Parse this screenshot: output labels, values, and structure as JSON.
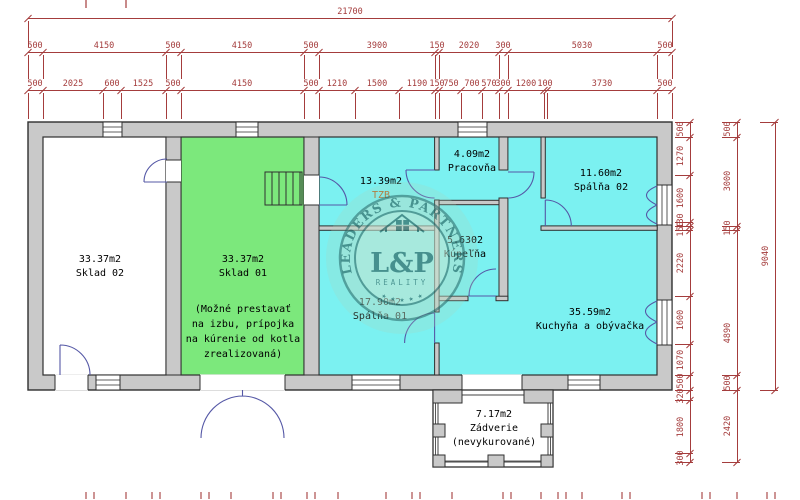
{
  "plan_title": "floor plan",
  "colors": {
    "wall_fill": "#c9c9c9",
    "outline": "#2f2f2f",
    "room_cyan": "#7bf1f1",
    "room_green": "#7ce87c",
    "dimension": "#a43c3c",
    "door_swing": "#5558a6",
    "tzb_label": "#b4641e",
    "watermark_teal": "#2e6e6c"
  },
  "rooms": {
    "sklad02": {
      "area": "33.37m2",
      "name": "Sklad 02"
    },
    "sklad01": {
      "area": "33.37m2",
      "name": "Sklad 01",
      "note_lines": [
        "(Možné prestavať",
        "na izbu, prípojka",
        "na kúrenie od kotla",
        "zrealizovaná)"
      ]
    },
    "tzb": {
      "area": "13.39m2",
      "name": "TZB"
    },
    "spalna01": {
      "area": "17.90m2",
      "name": "Spálňa 01"
    },
    "pracovna": {
      "area": "4.09m2",
      "name": "Pracovňa"
    },
    "kupelna": {
      "area": "5.6302",
      "name": "Kúpeľňa"
    },
    "spalna02": {
      "area": "11.60m2",
      "name": "Spálňa 02"
    },
    "kuchyna": {
      "area": "35.59m2",
      "name": "Kuchyňa a obývačka"
    },
    "zadverie": {
      "area": "7.17m2",
      "name": "Zádverie",
      "note": "(nevykurované)"
    }
  },
  "watermark": {
    "arc_text": "LEADERS & PARTNERS",
    "monogram": "L&P",
    "subtitle": "REALITY",
    "stars": "★ ★ ★ ★ ★"
  },
  "dims": {
    "top_rows": [
      {
        "y": 18,
        "x1": 28,
        "x2": 672,
        "ext": 26,
        "bounds": [
          28,
          672
        ],
        "labels": [
          {
            "t": "21700",
            "x": 350
          }
        ]
      },
      {
        "y": 52,
        "x1": 28,
        "x2": 672,
        "ext": 24,
        "bounds": [
          28,
          42.8,
          166,
          180.9,
          304,
          318.8,
          434.6,
          439.1,
          499,
          507.9,
          657.2,
          672
        ],
        "labels": [
          {
            "t": "500",
            "x": 35
          },
          {
            "t": "4150",
            "x": 104
          },
          {
            "t": "500",
            "x": 173
          },
          {
            "t": "4150",
            "x": 242
          },
          {
            "t": "500",
            "x": 311
          },
          {
            "t": "3900",
            "x": 377
          },
          {
            "t": "150",
            "x": 437
          },
          {
            "t": "2020",
            "x": 469
          },
          {
            "t": "300",
            "x": 503
          },
          {
            "t": "5030",
            "x": 582
          },
          {
            "t": "500",
            "x": 665
          }
        ]
      },
      {
        "y": 90,
        "x1": 28,
        "x2": 672,
        "ext": 26,
        "bounds": [
          28,
          42.8,
          103,
          120.8,
          166,
          180.9,
          304,
          318.8,
          354.7,
          399.2,
          434.6,
          439.1,
          461.3,
          482.1,
          499,
          507.9,
          543.5,
          546.5,
          657.2,
          672
        ],
        "labels": [
          {
            "t": "500",
            "x": 35
          },
          {
            "t": "2025",
            "x": 73
          },
          {
            "t": "600",
            "x": 112
          },
          {
            "t": "1525",
            "x": 143
          },
          {
            "t": "500",
            "x": 173
          },
          {
            "t": "4150",
            "x": 242
          },
          {
            "t": "500",
            "x": 311
          },
          {
            "t": "1210",
            "x": 337
          },
          {
            "t": "1500",
            "x": 377
          },
          {
            "t": "1190",
            "x": 417
          },
          {
            "t": "150",
            "x": 437
          },
          {
            "t": "750",
            "x": 451
          },
          {
            "t": "700",
            "x": 472
          },
          {
            "t": "570",
            "x": 489
          },
          {
            "t": "300",
            "x": 503
          },
          {
            "t": "1200",
            "x": 526
          },
          {
            "t": "100",
            "x": 545
          },
          {
            "t": "3730",
            "x": 602
          },
          {
            "t": "500",
            "x": 665
          }
        ]
      }
    ],
    "right_cols": [
      {
        "x": 690,
        "y1": 122,
        "y2": 462,
        "bounds": [
          122,
          136.8,
          174.5,
          222,
          225.9,
          230.3,
          296.2,
          343.7,
          375.4,
          390.3,
          399.8,
          453.2,
          462.1
        ],
        "labels": [
          {
            "t": "500",
            "y": 129
          },
          {
            "t": "1270",
            "y": 156
          },
          {
            "t": "1600",
            "y": 198
          },
          {
            "t": "130",
            "y": 221
          },
          {
            "t": "150",
            "y": 229
          },
          {
            "t": "2220",
            "y": 263
          },
          {
            "t": "1600",
            "y": 320
          },
          {
            "t": "1070",
            "y": 360
          },
          {
            "t": "500",
            "y": 381
          },
          {
            "t": "320",
            "y": 396
          },
          {
            "t": "1800",
            "y": 427
          },
          {
            "t": "300",
            "y": 458
          }
        ]
      },
      {
        "x": 737,
        "y1": 122,
        "y2": 462,
        "bounds": [
          122,
          136.8,
          225.9,
          230.3,
          375.4,
          390.3,
          462.1
        ],
        "labels": [
          {
            "t": "500",
            "y": 129
          },
          {
            "t": "3000",
            "y": 181
          },
          {
            "t": "150",
            "y": 228
          },
          {
            "t": "4890",
            "y": 333
          },
          {
            "t": "500",
            "y": 383
          },
          {
            "t": "2420",
            "y": 426
          }
        ]
      },
      {
        "x": 775,
        "y1": 122,
        "y2": 390,
        "bounds": [
          122,
          390.3
        ],
        "labels": [
          {
            "t": "9040",
            "y": 256
          }
        ]
      }
    ],
    "top_partial_ticks": [
      85,
      125
    ],
    "bottom_ticks": [
      85,
      93,
      125,
      151,
      159,
      200,
      208,
      230,
      272,
      280,
      306,
      314,
      337,
      385,
      411,
      419,
      451,
      502,
      510,
      540,
      557,
      565,
      581,
      621,
      629,
      701,
      709,
      736,
      766,
      774
    ]
  }
}
